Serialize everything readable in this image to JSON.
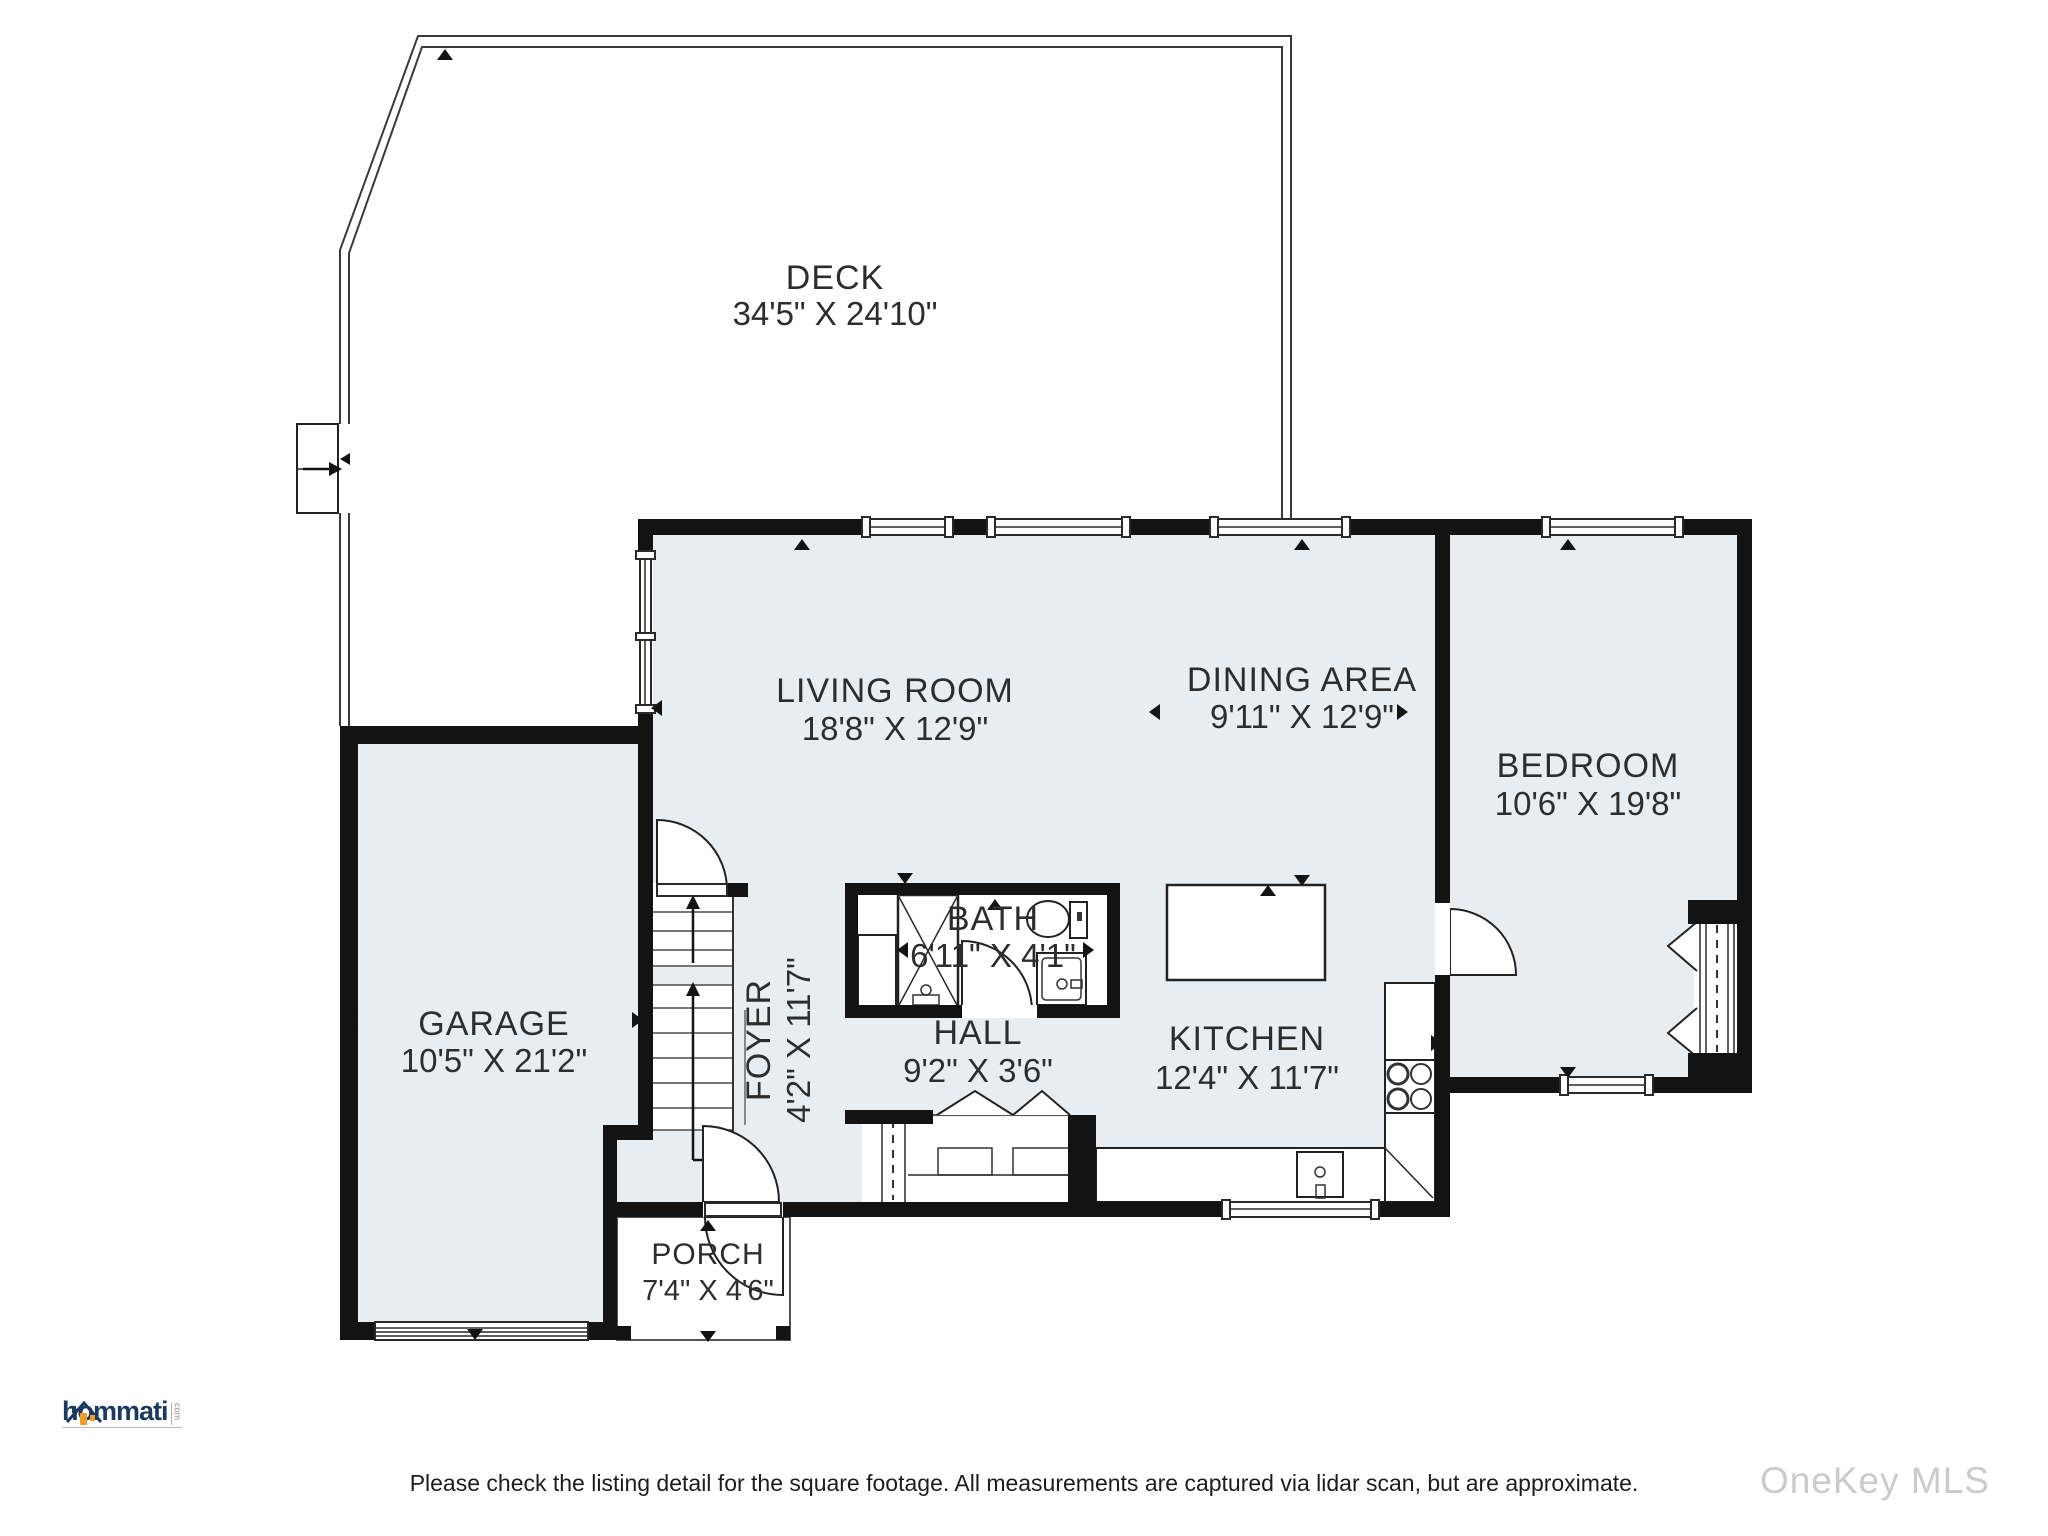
{
  "rooms": {
    "deck": {
      "label": "DECK",
      "dims": "34'5\" X 24'10\""
    },
    "living_room": {
      "label": "LIVING ROOM",
      "dims": "18'8\" X 12'9\""
    },
    "dining_area": {
      "label": "DINING AREA",
      "dims": "9'11\" X 12'9\""
    },
    "bedroom": {
      "label": "BEDROOM",
      "dims": "10'6\" X 19'8\""
    },
    "garage": {
      "label": "GARAGE",
      "dims": "10'5\" X 21'2\""
    },
    "bath": {
      "label": "BATH",
      "dims": "6'11\" X 4'1\""
    },
    "hall": {
      "label": "HALL",
      "dims": "9'2\" X 3'6\""
    },
    "kitchen": {
      "label": "KITCHEN",
      "dims": "12'4\" X 11'7\""
    },
    "foyer": {
      "label": "FOYER",
      "dims": "4'2\" X 11'7\""
    },
    "porch": {
      "label": "PORCH",
      "dims": "7'4\" X 4'6\""
    }
  },
  "branding": {
    "logo_text": "hommati",
    "logo_suffix": "com"
  },
  "footer": {
    "disclaimer": "Please check the listing detail for the square footage. All measurements are captured via lidar scan, but are approximate."
  },
  "watermark": {
    "text": "OneKey MLS"
  },
  "colors": {
    "room_fill": "#e8edf1",
    "wall": "#131313",
    "logo_navy": "#1c3a5e",
    "logo_orange": "#f39c2c",
    "watermark_gray": "#c9cbcd"
  }
}
